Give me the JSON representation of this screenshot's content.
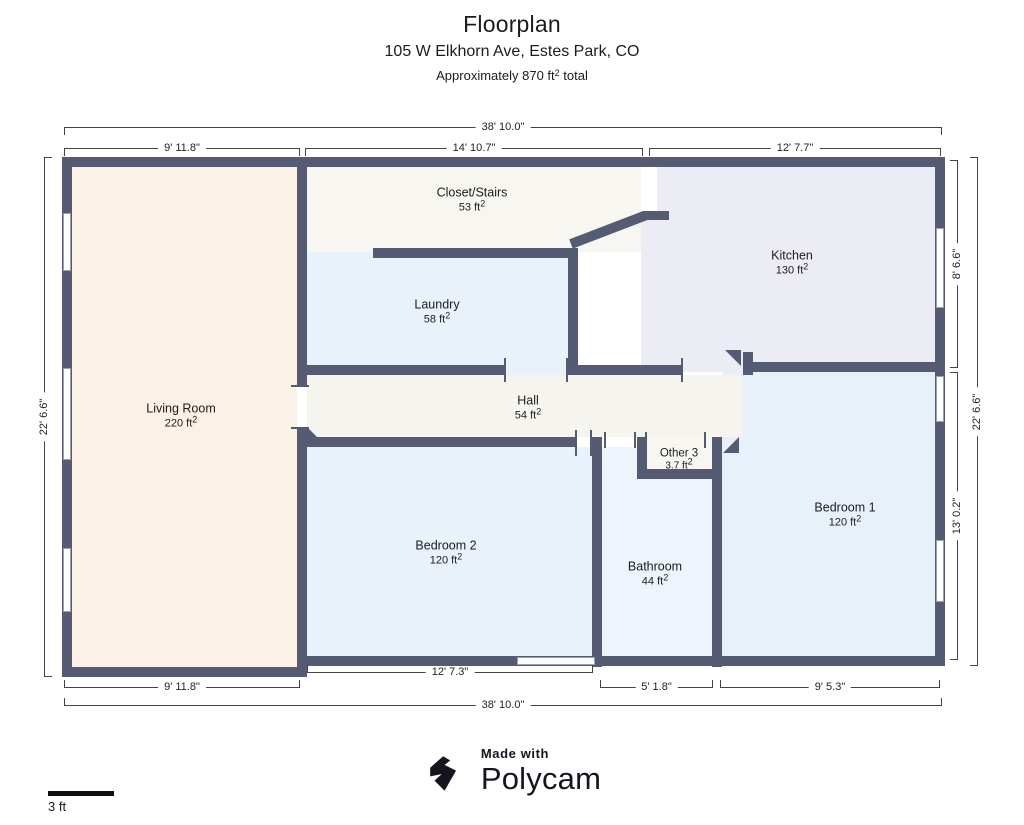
{
  "header": {
    "title": "Floorplan",
    "address": "105 W Elkhorn Ave, Estes Park, CO",
    "area_note_prefix": "Approximately 870 ft",
    "area_note_suffix": " total"
  },
  "sq": "2",
  "rooms": [
    {
      "label": "Living Room",
      "area": "220 ft"
    },
    {
      "label": "Closet/Stairs",
      "area": "53 ft"
    },
    {
      "label": "Laundry",
      "area": "58 ft"
    },
    {
      "label": "Kitchen",
      "area": "130 ft"
    },
    {
      "label": "Hall",
      "area": "54 ft"
    },
    {
      "label": "Other 3",
      "area": "3.7 ft"
    },
    {
      "label": "Bedroom 2",
      "area": "120 ft"
    },
    {
      "label": "Bathroom",
      "area": "44 ft"
    },
    {
      "label": "Bedroom 1",
      "area": "120 ft"
    }
  ],
  "dimensions": {
    "top_total": "38' 10.0\"",
    "top_left": "9' 11.8\"",
    "top_mid": "14' 10.7\"",
    "top_right": "12' 7.7\"",
    "left_total": "22' 6.6\"",
    "right_upper": "8' 6.6\"",
    "right_lower": "13' 0.2\"",
    "right_total": "22' 6.6\"",
    "bottom_left": "9' 11.8\"",
    "bottom_mid": "12' 7.3\"",
    "bottom_bath": "5' 1.8\"",
    "bottom_right": "9' 5.3\"",
    "bottom_total": "38' 10.0\""
  },
  "scale_bar": {
    "label": "3 ft"
  },
  "footer": {
    "made_with": "Made with",
    "brand": "Polycam"
  },
  "colors": {
    "wall": "#565b74",
    "living": "#fbf1e7",
    "closet": "#f7f6f0",
    "laundry": "#e9f1fb",
    "kitchen": "#ececf5",
    "hall": "#f5f4ee",
    "other": "#f7f6f0",
    "bed2": "#e9f1fb",
    "bath": "#edf4fb",
    "bed1": "#e8f0fa",
    "dim_line": "#444444",
    "text": "#1c1c1c",
    "brand": "#15151f"
  }
}
